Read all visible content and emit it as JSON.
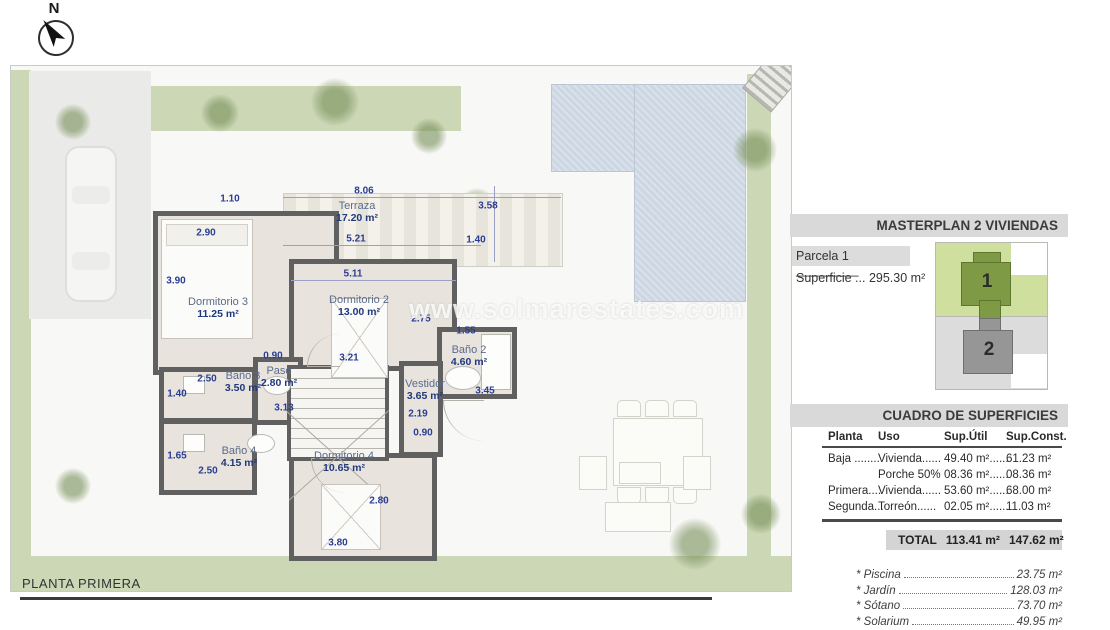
{
  "compass": {
    "label": "N"
  },
  "watermark": "www.solmarestates.com",
  "footer": {
    "title": "PLANTA PRIMERA"
  },
  "plan": {
    "rooms": [
      {
        "name": "Terraza",
        "area": "17.20 m²",
        "x": 346,
        "y": 146
      },
      {
        "name": "Dormitorio 3",
        "area": "11.25 m²",
        "x": 207,
        "y": 242
      },
      {
        "name": "Dormitorio 2",
        "area": "13.00 m²",
        "x": 348,
        "y": 240
      },
      {
        "name": "Baño 2",
        "area": "4.60 m²",
        "x": 458,
        "y": 290
      },
      {
        "name": "Vestidor",
        "area": "3.65 m²",
        "x": 414,
        "y": 324
      },
      {
        "name": "Paso",
        "area": "2.80 m²",
        "x": 268,
        "y": 311
      },
      {
        "name": "Baño 3",
        "area": "3.50 m²",
        "x": 232,
        "y": 316
      },
      {
        "name": "Baño 4",
        "area": "4.15 m²",
        "x": 228,
        "y": 391
      },
      {
        "name": "Dormitorio 4",
        "area": "10.65 m²",
        "x": 333,
        "y": 396
      }
    ],
    "dimensions": [
      {
        "t": "8.06",
        "x": 353,
        "y": 125
      },
      {
        "t": "1.10",
        "x": 219,
        "y": 133
      },
      {
        "t": "3.58",
        "x": 477,
        "y": 140
      },
      {
        "t": "2.90",
        "x": 195,
        "y": 167
      },
      {
        "t": "5.21",
        "x": 345,
        "y": 173
      },
      {
        "t": "1.40",
        "x": 465,
        "y": 174
      },
      {
        "t": "5.11",
        "x": 342,
        "y": 208
      },
      {
        "t": "3.90",
        "x": 165,
        "y": 215
      },
      {
        "t": "2.75",
        "x": 410,
        "y": 253
      },
      {
        "t": "1.55",
        "x": 455,
        "y": 265
      },
      {
        "t": "0.90",
        "x": 262,
        "y": 290
      },
      {
        "t": "3.21",
        "x": 338,
        "y": 292
      },
      {
        "t": "2.50",
        "x": 196,
        "y": 313
      },
      {
        "t": "3.45",
        "x": 474,
        "y": 325
      },
      {
        "t": "1.40",
        "x": 166,
        "y": 328
      },
      {
        "t": "3.13",
        "x": 273,
        "y": 342
      },
      {
        "t": "2.19",
        "x": 407,
        "y": 348
      },
      {
        "t": "0.90",
        "x": 412,
        "y": 367
      },
      {
        "t": "1.65",
        "x": 166,
        "y": 390
      },
      {
        "t": "2.50",
        "x": 197,
        "y": 405
      },
      {
        "t": "2.80",
        "x": 368,
        "y": 435
      },
      {
        "t": "3.80",
        "x": 327,
        "y": 477
      }
    ]
  },
  "sidebar": {
    "masterplan_title": "MASTERPLAN 2 VIVIENDAS",
    "parcela_label": "Parcela 1 _________",
    "superficie": "Superficie ... 295.30 m²",
    "diagram": {
      "plot1": "1",
      "plot2": "2"
    },
    "table": {
      "title": "CUADRO DE SUPERFICIES",
      "headers": [
        "Planta",
        "Uso",
        "Sup.Útil",
        "Sup.Const."
      ],
      "rows": [
        [
          "Baja ........",
          "Vivienda......",
          "49.40 m²......",
          "61.23 m²"
        ],
        [
          "",
          "Porche 50%",
          "08.36 m²......",
          "08.36 m²"
        ],
        [
          "Primera....",
          "Vivienda......",
          "53.60 m²......",
          "68.00 m²"
        ],
        [
          "Segunda...",
          "Torreón......",
          "02.05 m²......",
          "11.03 m²"
        ]
      ],
      "total_label": "TOTAL",
      "total_util": "113.41 m²",
      "total_const": "147.62 m²"
    },
    "extras": [
      {
        "label": "* Piscina",
        "value": "23.75 m²"
      },
      {
        "label": "* Jardín",
        "value": "128.03 m²"
      },
      {
        "label": "* Sótano",
        "value": "73.70 m²"
      },
      {
        "label": "* Solarium",
        "value": "49.95 m²"
      }
    ]
  }
}
